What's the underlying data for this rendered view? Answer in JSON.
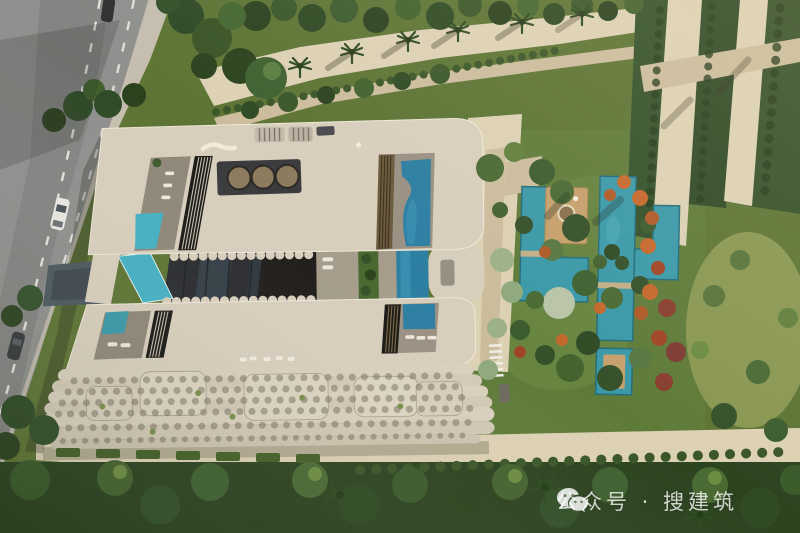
{
  "scene": {
    "alt": "Aerial top-down architectural rendering: cream terraced residential block with rooftop pools and glass atrium, landscaped garden with turquoise water channels, curving road on the left, sandy promenades and dense tree canopies"
  },
  "watermark": {
    "icon": "wechat-icon",
    "text": "公众号 · 搜建筑"
  },
  "palette": {
    "road": "#8f8f8d",
    "kerb": "#c6bfb0",
    "sand": "#ddd1b4",
    "sandshade": "#cbbc9c",
    "building": "#d8cebc",
    "buildinglight": "#e6ddcc",
    "buildingshadow": "#a89e8c",
    "glass": "#2a2c2f",
    "slat": "#1a1916",
    "panel": "#3b3b3d",
    "skylight": "#8c7b5c",
    "poolbright": "#45b0c2",
    "pooldeep": "#2d7fa2",
    "gardenwater": "#3b99a8",
    "canal": "#4b585e",
    "deck": "#c6a06c",
    "grass": "#5d7434",
    "greendark": "#2c431f",
    "green": "#41612c",
    "greenlight": "#6d8c43",
    "orange": "#c4682c",
    "watermarkwhite": "#ffffff"
  }
}
